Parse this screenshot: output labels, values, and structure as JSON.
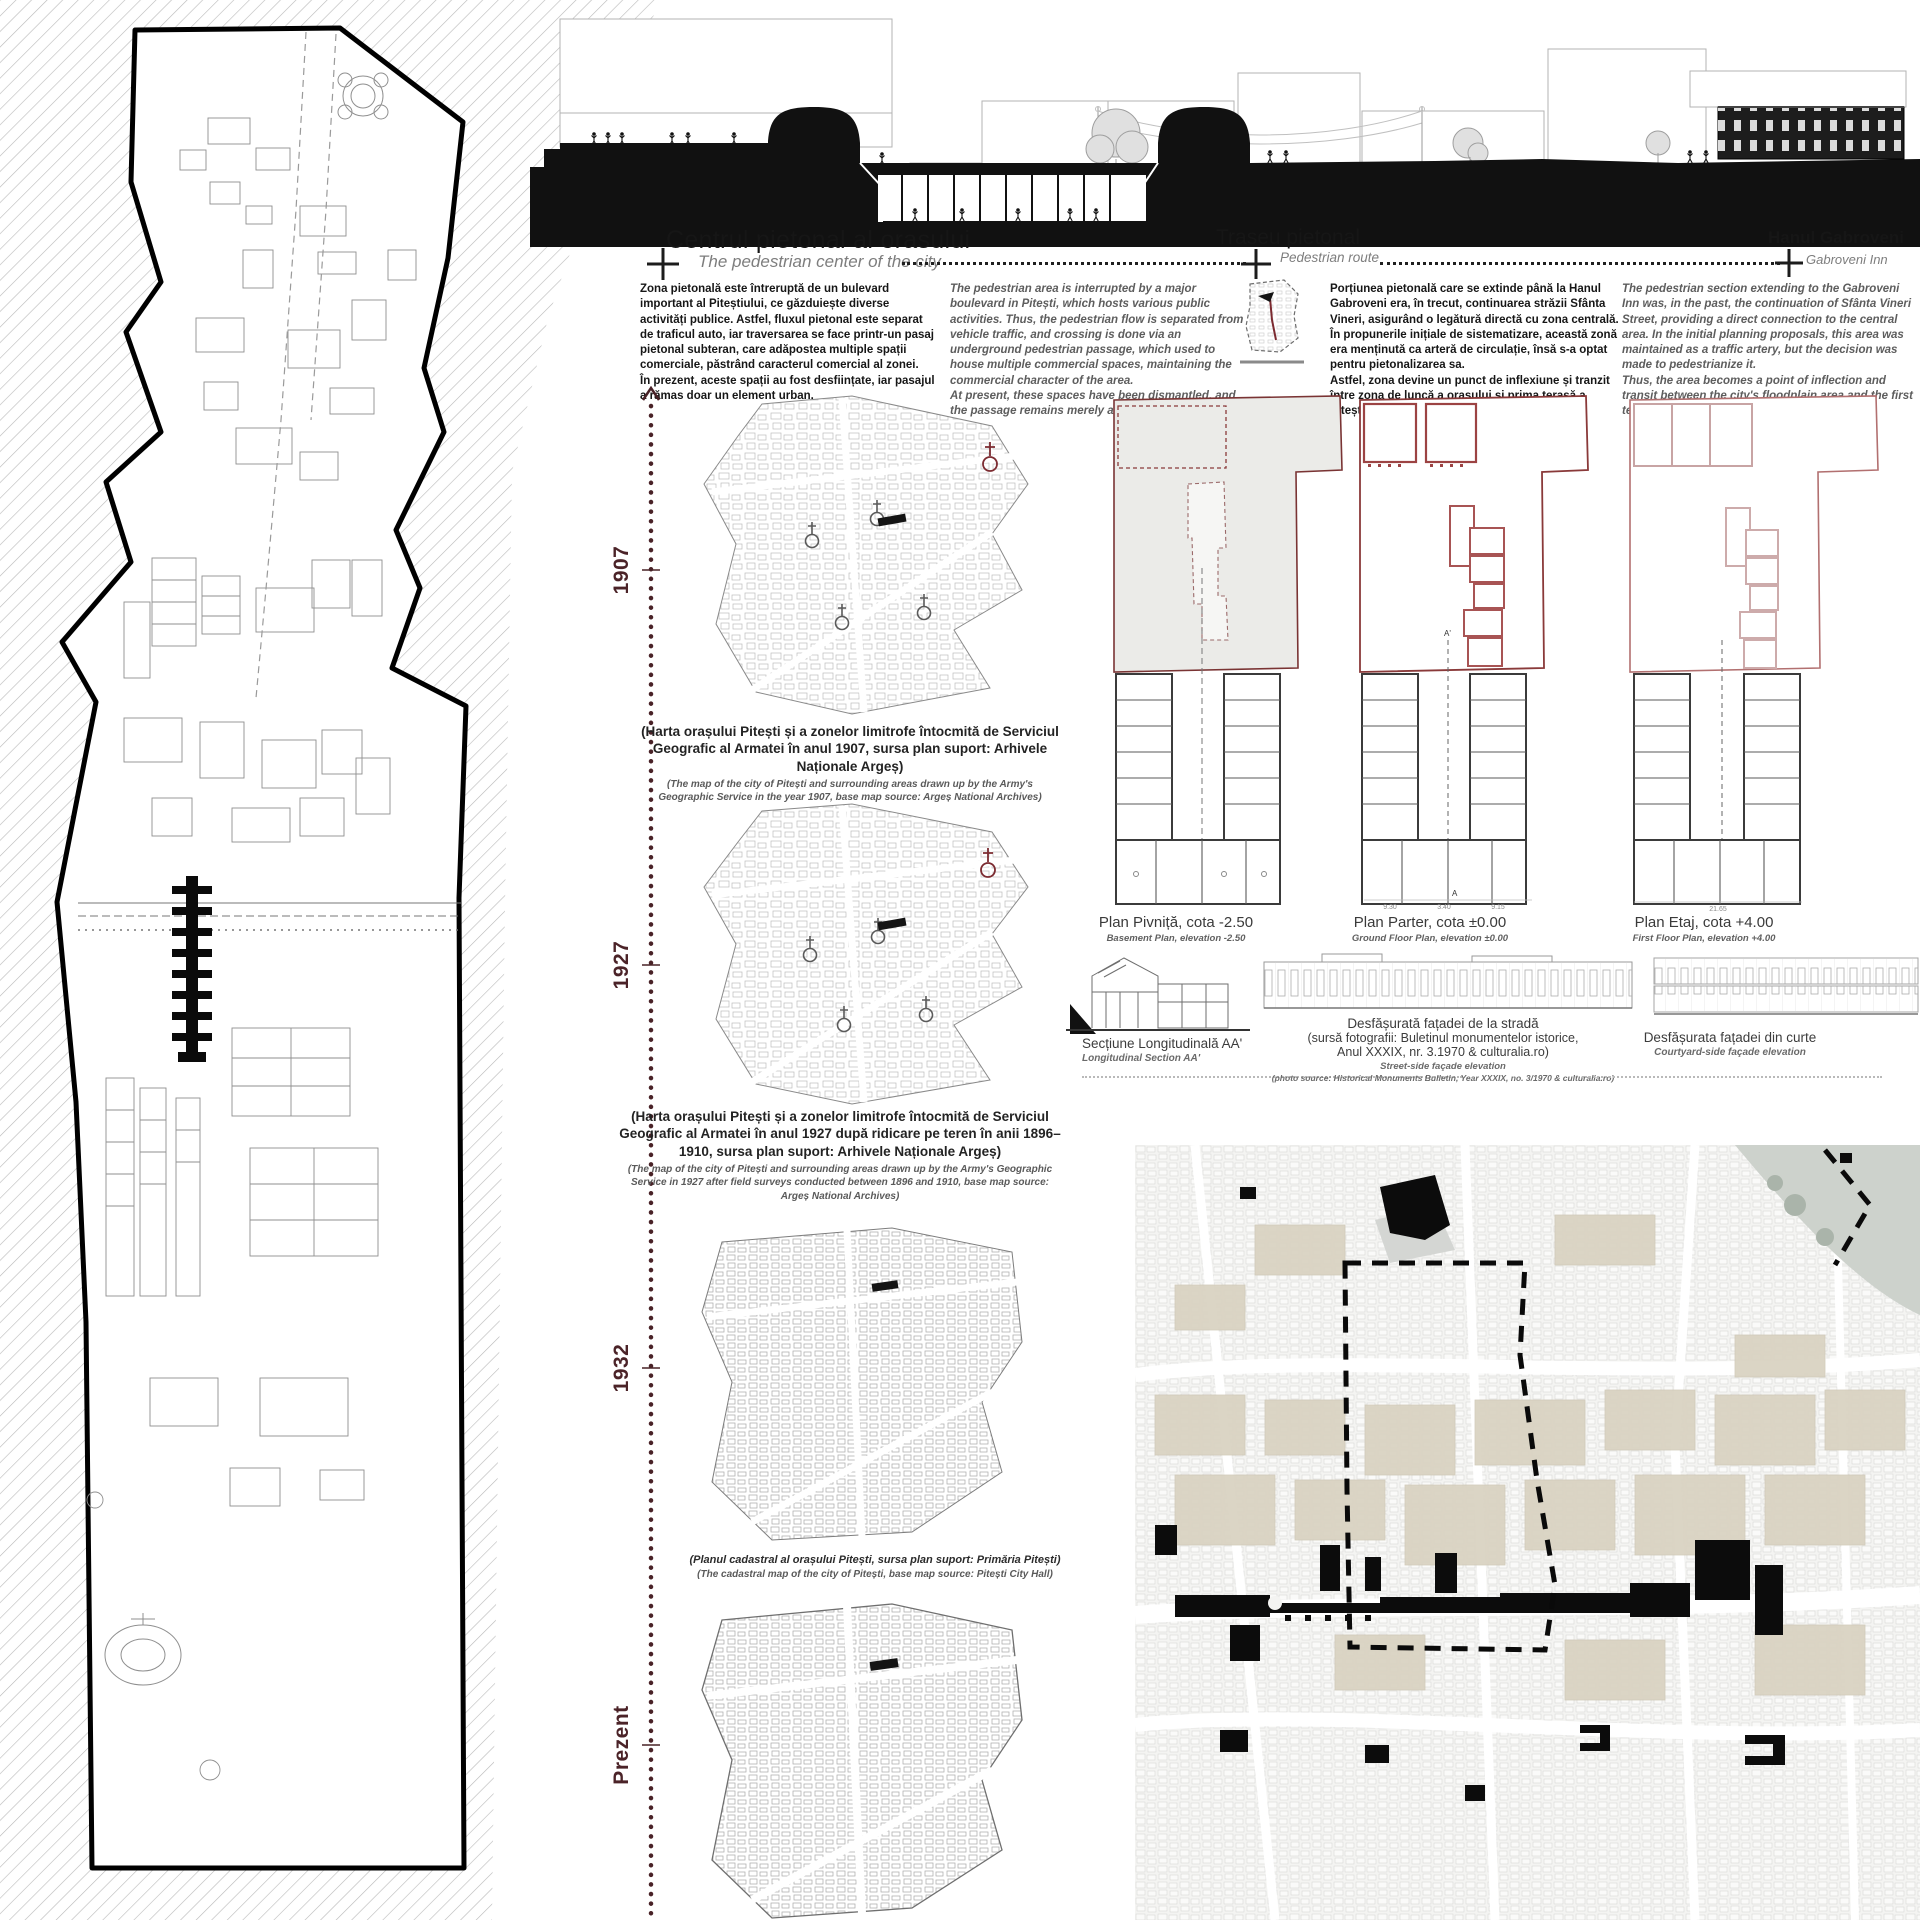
{
  "headers": {
    "center": {
      "title": "Centrul pietonal al orasului",
      "subtitle": "The pedestrian center of the city"
    },
    "route": {
      "title": "Traseu pietonal",
      "subtitle": "Pedestrian route"
    },
    "inn": {
      "title": "Hanul Gabroveni",
      "subtitle": "Gabroveni Inn"
    }
  },
  "intro": {
    "ro_1a": "Zona pietonală este întreruptă de un bulevard important al Piteștiului, ce găzduiește diverse activități publice. Astfel, fluxul pietonal este separat de traficul auto, iar traversarea se face printr-un pasaj pietonal subteran, care adăpostea multiple spații comerciale, păstrând caracterul comercial al zonei.",
    "ro_1b": "În prezent, aceste spații au fost desființate, iar pasajul a rămas doar un element urban.",
    "en_1a": "The pedestrian area is interrupted by a major boulevard in Pitești, which hosts various public activities. Thus, the pedestrian flow is separated from vehicle traffic, and crossing is done via an underground pedestrian passage, which used to house multiple commercial spaces, maintaining the commercial character of the area.",
    "en_1b": "At present, these spaces have been dismantled, and the passage remains merely an urban element.",
    "ro_2a": "Porțiunea pietonală care se extinde până la Hanul Gabroveni era, în trecut, continuarea străzii Sfânta Vineri, asigurând o legătură directă cu zona centrală. În propunerile inițiale de sistematizare, această zonă era menținută ca arteră de circulație, însă s-a optat pentru pietonalizarea sa.",
    "ro_2b": "Astfel, zona devine un punct de inflexiune și tranzit între zona de luncă a orașului și prima terasă a Piteștiului.",
    "en_2a": "The pedestrian section extending to the Gabroveni Inn was, in the past, the continuation of Sfânta Vineri Street, providing a direct connection to the central area. In the initial planning proposals, this area was maintained as a traffic artery, but the decision was made to pedestrianize it.",
    "en_2b": "Thus, the area becomes a point of inflection and transit between the city's floodplain area and the first terrace of Pitești."
  },
  "timeline": {
    "y1907": "1907",
    "y1927": "1927",
    "y1932": "1932",
    "present": "Prezent"
  },
  "captions": {
    "c1907_ro": "(Harta orașului Pitești și a zonelor limitrofe întocmită de Serviciul Geografic al Armatei în anul 1907, sursa plan suport: Arhivele Naționale Argeș)",
    "c1907_en": "(The map of the city of Pitești and surrounding areas drawn up by the Army's Geographic Service in the year 1907, base map source: Argeș National Archives)",
    "c1927_ro": "(Harta orașului Pitești și a zonelor limitrofe întocmită de Serviciul Geografic al Armatei în anul 1927 după ridicare pe teren în anii 1896–1910, sursa plan suport: Arhivele Naționale Argeș)",
    "c1927_en": "(The map of the city of Pitești and surrounding areas drawn up by the Army's Geographic Service in 1927 after field surveys conducted between 1896 and 1910, base map source: Argeș National Archives)",
    "c1932_ro": "(Planul cadastral al orașului Pitești, sursa plan suport: Primăria Pitești)",
    "c1932_en": "(The cadastral map of the city of Pitești, base map source: Pitești City Hall)"
  },
  "plans": [
    {
      "ro": "Plan Pivniță, cota -2.50",
      "en": "Basement Plan, elevation -2.50"
    },
    {
      "ro": "Plan Parter, cota ±0.00",
      "en": "Ground Floor Plan, elevation ±0.00"
    },
    {
      "ro": "Plan Etaj, cota +4.00",
      "en": "First Floor Plan, elevation +4.00"
    }
  ],
  "ann": {
    "sec_top": "A'",
    "sec_bottom": "A",
    "d1": "9.30",
    "d2": "3.40",
    "d3": "9.15",
    "d4": "21.65"
  },
  "sections": {
    "long_ro": "Secțiune Longitudinală AA'",
    "long_en": "Longitudinal Section AA'",
    "street_ro1": "Desfășurată fațadei de la stradă",
    "street_ro2": "(sursă fotografii: Buletinul monumentelor istorice,",
    "street_ro3": "Anul XXXIX, nr. 3.1970 & culturalia.ro)",
    "street_en1": "Street-side façade elevation",
    "street_en2": "(photo source: Historical Monuments Bulletin, Year XXXIX, no. 3/1970 & culturalia.ro)",
    "court_ro": "Desfășurata fațadei din curte",
    "court_en": "Courtyard-side façade elevation"
  }
}
